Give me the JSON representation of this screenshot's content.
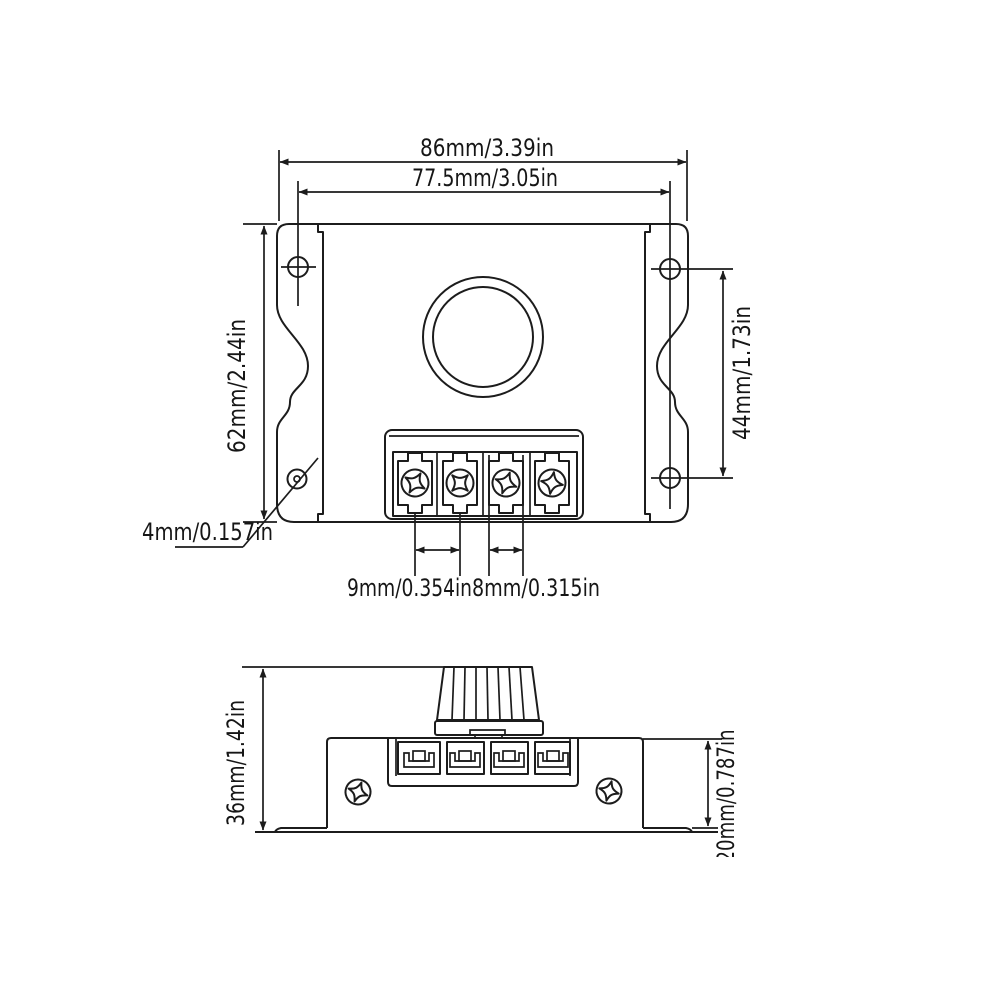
{
  "drawing": {
    "type": "technical-dimension-drawing",
    "background": "#ffffff",
    "line_color": "#1c1c1c",
    "top_view": {
      "name": "top view of controller with mounting wings, knob hole and 4-screw terminal block",
      "dims": {
        "overall_width": "86mm/3.39in",
        "mount_hole_spacing_width": "77.5mm/3.05in",
        "overall_height": "62mm/2.44in",
        "mount_hole_spacing_height": "44mm/1.73in",
        "mount_hole_diameter": "4mm/0.157in",
        "terminal_screw_pitch": "9mm/0.354in",
        "terminal_slot_width": "8mm/0.315in"
      }
    },
    "side_view": {
      "name": "side view with knob, terminal clips and mounting base",
      "dims": {
        "overall_height_with_knob": "36mm/1.42in",
        "body_height": "20mm/0.787in"
      }
    }
  }
}
